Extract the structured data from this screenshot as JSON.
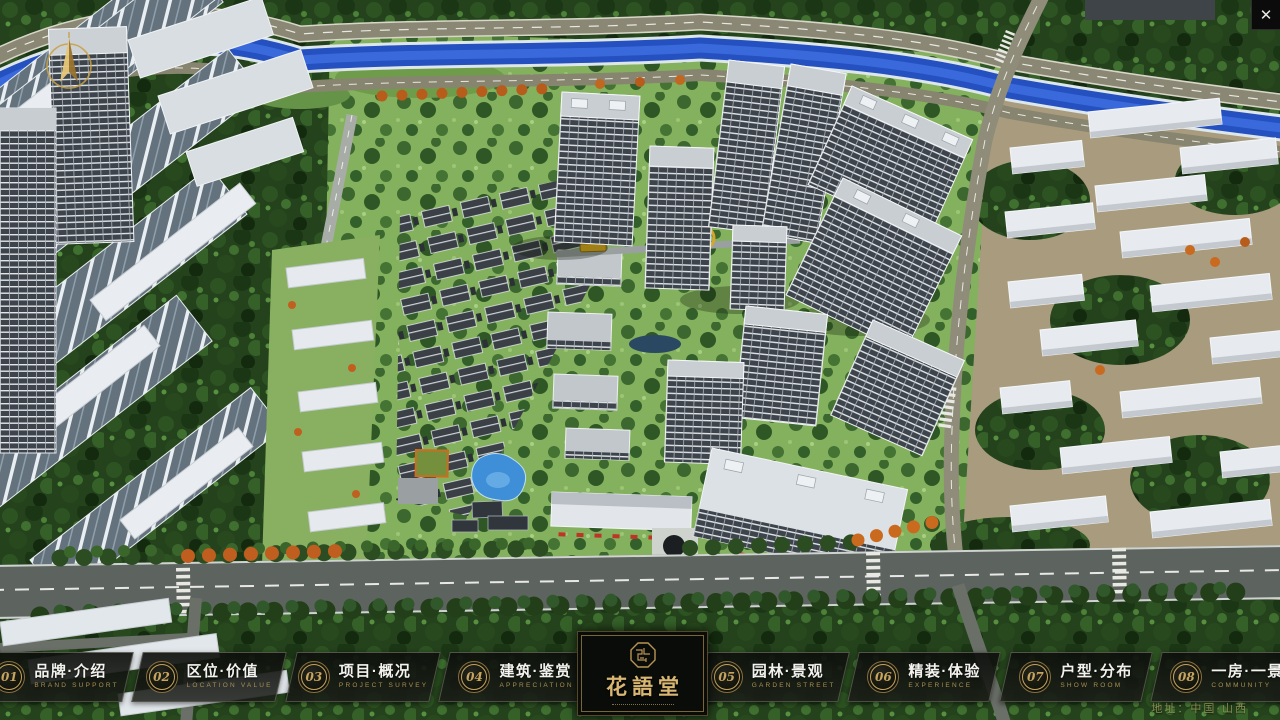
{
  "header": {
    "close_label": "✕"
  },
  "nav": {
    "items": [
      {
        "num": "01",
        "zh": "品牌·介绍",
        "en": "BRAND SUPPORT"
      },
      {
        "num": "02",
        "zh": "区位·价值",
        "en": "LOCATION VALUE"
      },
      {
        "num": "03",
        "zh": "项目·概况",
        "en": "PROJECT SURVEY"
      },
      {
        "num": "04",
        "zh": "建筑·鉴赏",
        "en": "APPRECIATION"
      },
      {
        "num": "05",
        "zh": "园林·景观",
        "en": "GARDEN STREET"
      },
      {
        "num": "06",
        "zh": "精装·体验",
        "en": "EXPERIENCE"
      },
      {
        "num": "07",
        "zh": "户型·分布",
        "en": "SHOW ROOM"
      },
      {
        "num": "08",
        "zh": "一房·一景",
        "en": "COMMUNITY"
      }
    ]
  },
  "logo": {
    "title": "花語堂"
  },
  "footer": {
    "address": "地址：中国·山西"
  },
  "colors": {
    "gold": "#c7a55e",
    "gold-dim": "#a98f54",
    "text-white": "#f2f2ee",
    "address-olive": "#8f9253",
    "river-blue": "#2450c0",
    "road-gray": "#87846f",
    "main-road": "#5d635e",
    "forest-green": "#24421c",
    "lawn-green": "#84b15e",
    "building-white": "#e7ebf0"
  }
}
